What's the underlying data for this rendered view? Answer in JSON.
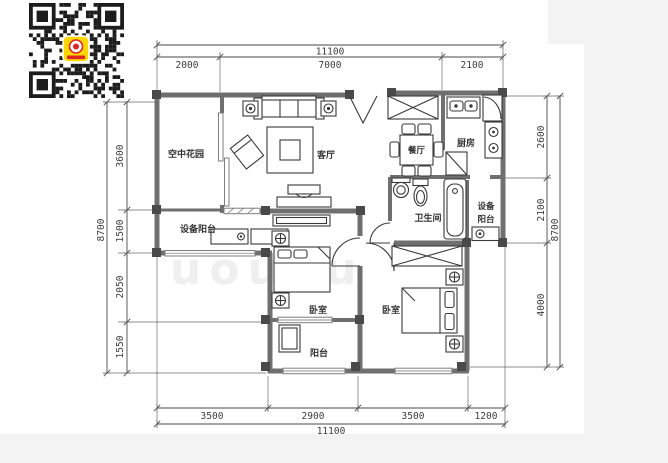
{
  "page": {
    "background": "#f3f3f3",
    "canvas": "#ffffff"
  },
  "qr": {
    "module_color": "#1c1c1c",
    "bg": "#ffffff",
    "logo_bg": "#ffd800",
    "logo_accent": "#e02525"
  },
  "watermark": {
    "text": "uouou"
  },
  "plan": {
    "colors": {
      "wall": "#6f6f6f",
      "column": "#4a4a4a",
      "furniture": "#3a3a3a",
      "dim_text": "#3c3c3c"
    },
    "rooms": {
      "sky_garden": "空中花园",
      "living": "客厅",
      "dining": "餐厅",
      "kitchen": "厨房",
      "bath": "卫生间",
      "equip_left": "设备阳台",
      "equip_right_1": "设备",
      "equip_right_2": "阳台",
      "bedroom_left": "卧室",
      "bedroom_right": "卧室",
      "balcony": "阳台"
    },
    "dims": {
      "top_total": "11100",
      "top_1": "2000",
      "top_2": "7000",
      "top_3": "2100",
      "bottom_total": "11100",
      "bottom_1": "3500",
      "bottom_2": "2900",
      "bottom_3": "3500",
      "bottom_4": "1200",
      "left_total": "8700",
      "left_1": "3600",
      "left_2": "1500",
      "left_3": "2050",
      "left_4": "1550",
      "right_total": "8700",
      "right_1": "2600",
      "right_2": "2100",
      "right_3": "4000"
    }
  }
}
